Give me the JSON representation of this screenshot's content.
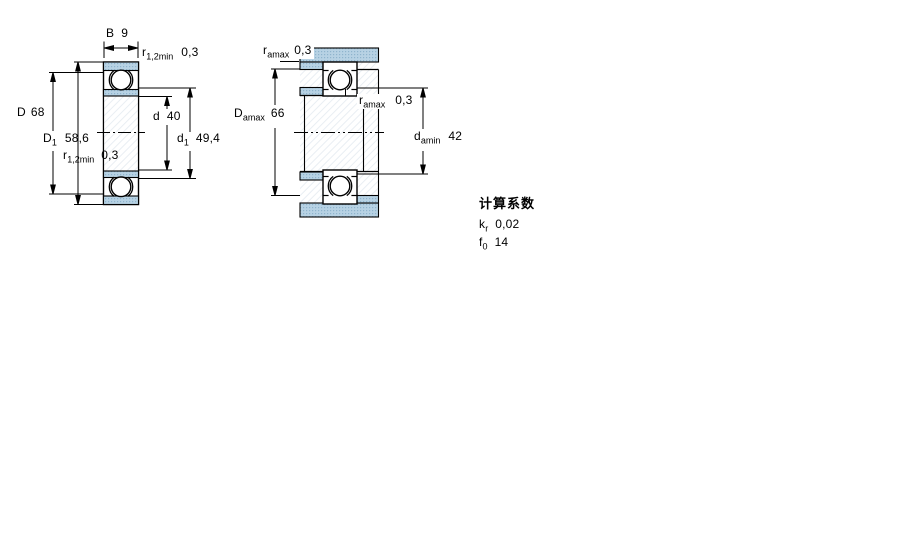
{
  "drawing": {
    "left_view": {
      "dims": {
        "B": {
          "symbol": "B",
          "value": "9"
        },
        "r12_top": {
          "symbol": "r",
          "sub": "1,2min",
          "value": "0,3"
        },
        "D": {
          "symbol": "D",
          "value": "68"
        },
        "D1": {
          "symbol": "D",
          "sub": "1",
          "value": "58,6"
        },
        "r12_bottom": {
          "symbol": "r",
          "sub": "1,2min",
          "value": "0,3"
        },
        "d": {
          "symbol": "d",
          "value": "40"
        },
        "d1": {
          "symbol": "d",
          "sub": "1",
          "value": "49,4"
        }
      }
    },
    "right_view": {
      "dims": {
        "ra_top": {
          "symbol": "r",
          "sub": "amax",
          "value": "0,3"
        },
        "Da_max": {
          "symbol": "D",
          "sub": "amax",
          "value": "66"
        },
        "ra_mid": {
          "symbol": "r",
          "sub": "amax",
          "value": "0,3"
        },
        "da_min": {
          "symbol": "d",
          "sub": "amin",
          "value": "42"
        }
      }
    },
    "calculation_factors": {
      "title": "计算系数",
      "rows": [
        {
          "symbol": "k",
          "sub": "r",
          "value": "0,02"
        },
        {
          "symbol": "f",
          "sub": "0",
          "value": "14"
        }
      ]
    },
    "colors": {
      "section_fill": "#b7d2e4",
      "section_dot": "#8fb4cd",
      "line": "#000000"
    }
  }
}
